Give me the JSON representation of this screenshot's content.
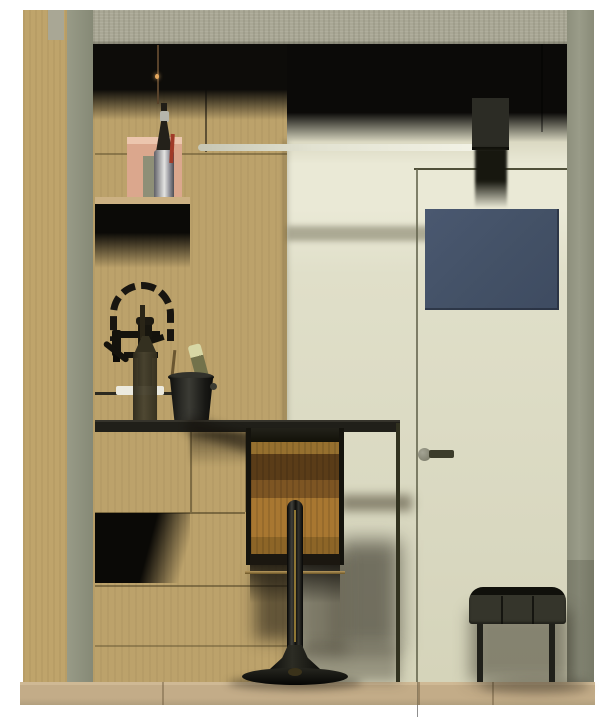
{
  "scene": {
    "title": "Interior elevation render — oak bar niche with flush door",
    "style": "3D architectural rendering, no visible text",
    "regions": {
      "ceiling_beam": {
        "label": "concrete ceiling beam",
        "color": "#a9a795"
      },
      "left_wall": {
        "label": "oak wall section",
        "color": "#bfa46b"
      },
      "pillar": {
        "label": "gray wall pillar",
        "color": "#8f9280"
      },
      "bar_wall": {
        "label": "oak bar back wall",
        "color": "#bca26b"
      },
      "door_wall": {
        "label": "cream wall with flush door",
        "color": "#dedcc5"
      },
      "right_edge": {
        "label": "gray wall edge",
        "color": "#90927f"
      },
      "floor": {
        "label": "oak floor strip",
        "color": "#c3ac88"
      },
      "ceiling_shadow": {
        "label": "dark ceiling shadow band",
        "color": "#0d0c09"
      }
    },
    "objects": {
      "light_bar": {
        "label": "linear suspended light",
        "color": "#f3f3e7"
      },
      "pendant_duct": {
        "label": "black pendant fixture",
        "color": "#1c1c15"
      },
      "blue_panel": {
        "label": "slate blue panel on door",
        "color": "#45526a"
      },
      "door": {
        "label": "flush door with reveal line",
        "color": "#dcdbc2"
      },
      "door_handle": {
        "label": "door lever handle",
        "color": "#3c3c2b"
      },
      "shelf": {
        "label": "oak wall shelf",
        "color": "#ccb183"
      },
      "artwork": {
        "label": "pink leaning artwork",
        "color": "#dba78d"
      },
      "shelf_bottle": {
        "label": "glass bottle on shelf",
        "color": "#c6c6c6"
      },
      "pendant_cord": {
        "label": "hanging filament bulb cord",
        "color": "#58422a"
      },
      "faucet": {
        "label": "black spring coil faucet",
        "color": "#17150e"
      },
      "wine_bottle": {
        "label": "dark wine bottle on counter",
        "color": "#3a3424"
      },
      "ice_bucket": {
        "label": "ice bucket with champagne",
        "color": "#1d1d19"
      },
      "champagne": {
        "label": "champagne bottle",
        "color": "#72724b"
      },
      "countertop": {
        "label": "dark bar countertop",
        "color": "#201f19"
      },
      "cabinets": {
        "label": "oak base cabinets with niche",
        "color": "#bca26b"
      },
      "bar_stool": {
        "label": "wooden pedestal bar stool",
        "color": "#a87731"
      },
      "stool_base": {
        "label": "black trumpet stool base",
        "color": "#0e0e0b"
      },
      "bench": {
        "label": "black upholstered bench",
        "color": "#35352b"
      }
    }
  }
}
